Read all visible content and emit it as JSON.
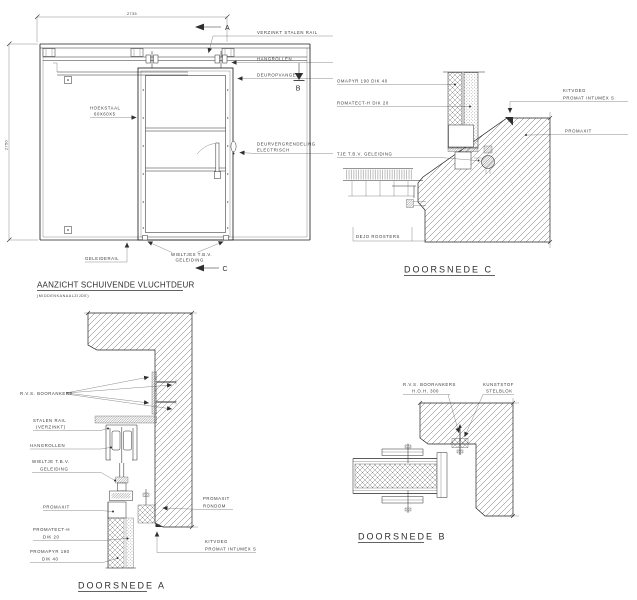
{
  "elevation": {
    "title": "AANZICHT SCHUIVENDE VLUCHTDEUR",
    "subtitle": "(MIDDENKANAALZIJDE)",
    "dim_width": "2735",
    "dim_height": "2750",
    "marker_a": "A",
    "marker_b": "B",
    "marker_c": "C",
    "labels": {
      "rail": "VERZINKT STALEN RAIL",
      "hangrollen": "HANGROLLEN",
      "deuropvanger": "DEUROPVANGER",
      "vergrendeling_line1": "DEURVERGRENDELING",
      "vergrendeling_line2": "ELECTRISCH",
      "geleiderail": "GELEIDERAIL",
      "hoekstaal_line1": "HOEKSTAAL",
      "hoekstaal_line2": "60X60X5",
      "wieltjes_line1": "WIELTJES T.B.V.",
      "wieltjes_line2": "GELEIDING"
    }
  },
  "doorsnede_c": {
    "title": "DOORSNEDE C",
    "labels": {
      "promapyr": "OMAPYR 190 DIK 40",
      "promatect": "ROMATECT-H DIK 20",
      "wieltje": "TJE T.B.V. GELEIDING",
      "kitvoeg_line1": "KITVOEG",
      "kitvoeg_line2": "PROMAT INTUMEX S",
      "promaxit": "PROMAXIT",
      "dejo_roosters": "DEJO ROOSTERS"
    }
  },
  "doorsnede_a": {
    "title": "DOORSNEDE A",
    "labels": {
      "boorankers": "R.V.S. BOORANKERS",
      "stalen_rail_line1": "STALEN RAIL",
      "stalen_rail_line2": "(VERZINKT)",
      "hangrollen": "HANGROLLEN",
      "wieltje_line1": "WIELTJE T.B.V.",
      "wieltje_line2": "GELEIDING",
      "promaxit": "PROMAXIT",
      "promatect_line1": "PROMATECT-H",
      "promatect_line2": "DIK 20",
      "promapyr_line1": "PROMAPYR 190",
      "promapyr_line2": "DIK 40",
      "promaxit_rondom_line1": "PROMAXIT",
      "promaxit_rondom_line2": "RONDOM",
      "kitvoeg_line1": "KITVOEG",
      "kitvoeg_line2": "PROMAT INTUMEX S"
    }
  },
  "doorsnede_b": {
    "title": "DOORSNEDE B",
    "labels": {
      "boorankers_line1": "R.V.S. BOORANKERS",
      "boorankers_line2": "H.O.H. 300",
      "stelblok_line1": "KUNSTSTOF",
      "stelblok_line2": "STELBLOK"
    }
  },
  "colors": {
    "line": "#2e2e2e",
    "background": "#ffffff"
  }
}
